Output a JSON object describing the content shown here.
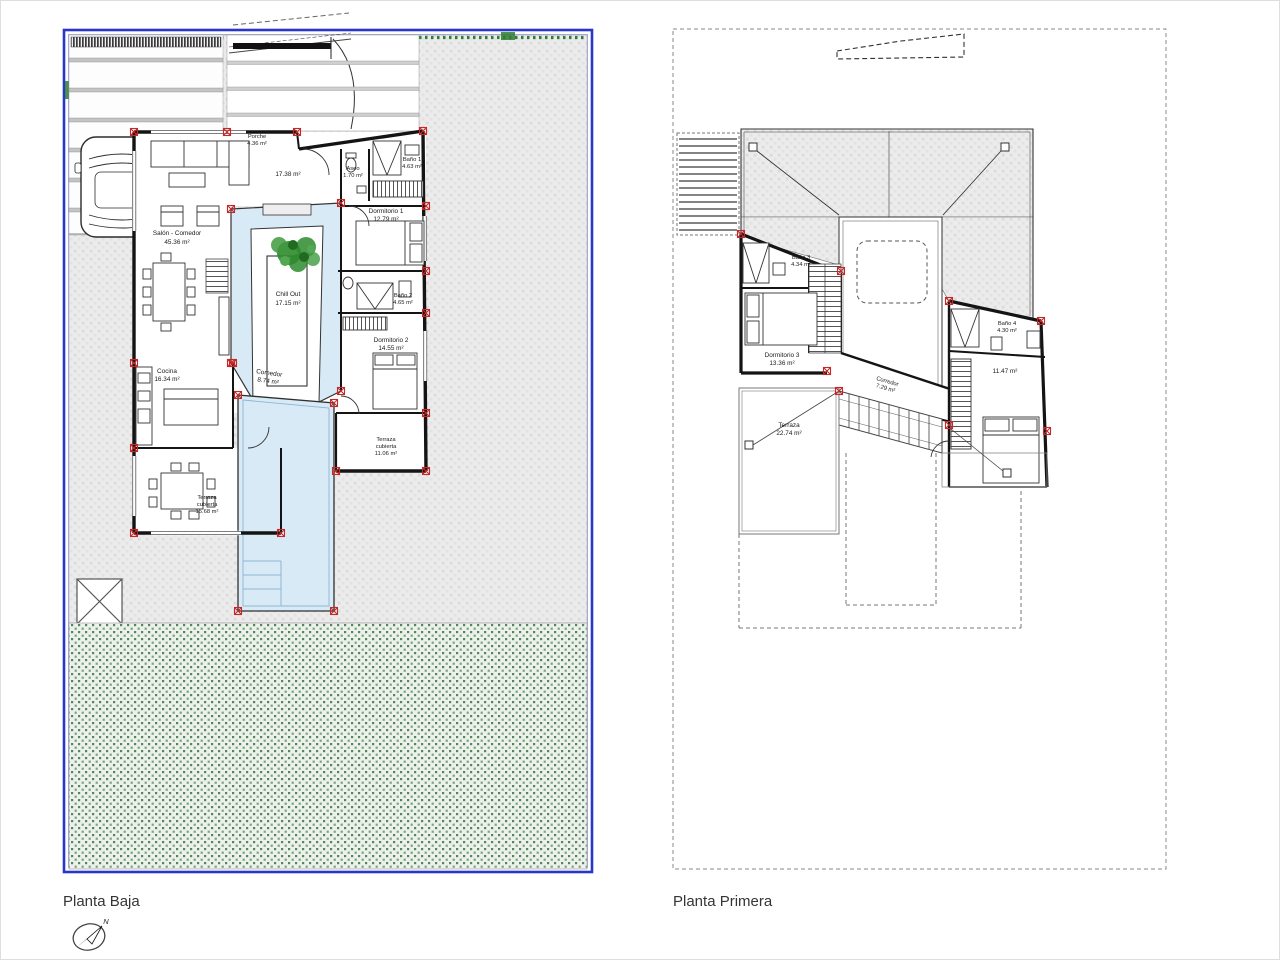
{
  "ground": {
    "title": "Planta Baja",
    "rooms": {
      "porche": {
        "name": "Porche",
        "area": "4.36 m²"
      },
      "salon": {
        "name": "Salón - Comedor",
        "area": "45.36 m²"
      },
      "hall": {
        "area": "17.38 m²"
      },
      "aseo": {
        "name": "Aseo",
        "area": "1.70 m²"
      },
      "bano1": {
        "name": "Baño 1",
        "area": "4.63 m²"
      },
      "dorm1": {
        "name": "Dormitorio 1",
        "area": "12.79 m²"
      },
      "bano2": {
        "name": "Baño 2",
        "area": "4.65 m²"
      },
      "dorm2": {
        "name": "Dormitorio 2",
        "area": "14.55 m²"
      },
      "cocina": {
        "name": "Cocina",
        "area": "16.34 m²"
      },
      "comedor": {
        "name": "Comedor",
        "area": "8.74 m²"
      },
      "chillout": {
        "name": "Chill Out",
        "area": "17.15 m²"
      },
      "terraza_cubierta_1": {
        "name": "Terraza",
        "name2": "cubierta",
        "area": "15.68 m²"
      },
      "terraza_cubierta_2": {
        "name": "Terraza",
        "name2": "cubierta",
        "area": "11.06 m²"
      }
    }
  },
  "first": {
    "title": "Planta Primera",
    "rooms": {
      "bano3": {
        "name": "Baño 3",
        "area": "4.34 m²"
      },
      "dorm3": {
        "name": "Dormitorio 3",
        "area": "13.36 m²"
      },
      "corredor": {
        "name": "Corredor",
        "area": "7.29 m²"
      },
      "bano4": {
        "name": "Baño 4",
        "area": "4.30 m²"
      },
      "dorm4": {
        "area": "11.47 m²"
      },
      "terraza": {
        "name": "Terraza",
        "area": "22.74 m²"
      }
    }
  },
  "compass": {
    "north": "N"
  },
  "colors": {
    "plot_border": "#2936c8",
    "water": "#d8eaf6",
    "lawn_dot": "#55855a",
    "paving": "#ececec",
    "wall": "#141414",
    "pillar_marker": "#c62828",
    "hedge": "#2f7d33",
    "tree": "#2e8b2e"
  }
}
